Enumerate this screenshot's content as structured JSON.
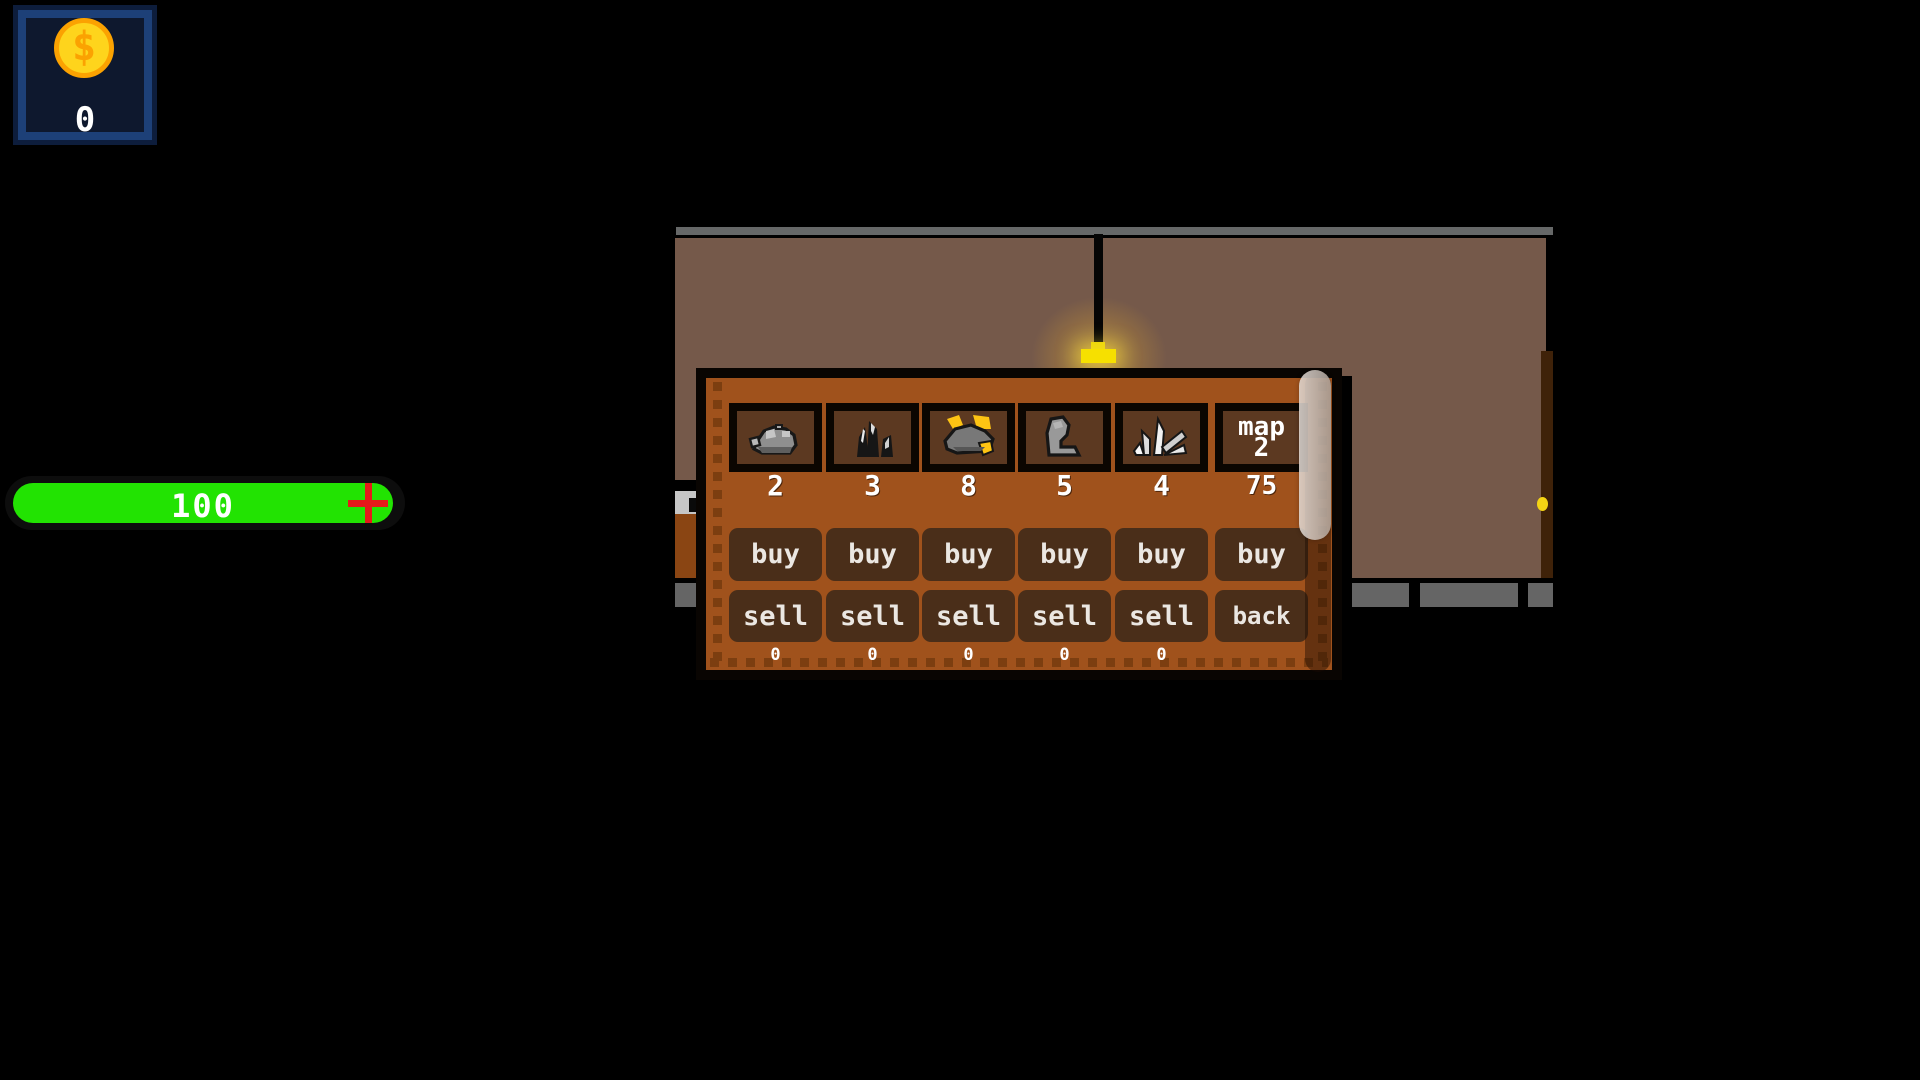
{
  "hud": {
    "money": {
      "symbol": "$",
      "value": "0"
    },
    "health": {
      "value": "100"
    }
  },
  "shop": {
    "items": [
      {
        "name": "stone-ore",
        "price": "2",
        "buy_label": "buy",
        "sell_label": "sell",
        "count": "0"
      },
      {
        "name": "coal",
        "price": "3",
        "buy_label": "buy",
        "sell_label": "sell",
        "count": "0"
      },
      {
        "name": "gold-ore",
        "price": "8",
        "buy_label": "buy",
        "sell_label": "sell",
        "count": "0"
      },
      {
        "name": "leather",
        "price": "5",
        "buy_label": "buy",
        "sell_label": "sell",
        "count": "0"
      },
      {
        "name": "crystal",
        "price": "4",
        "buy_label": "buy",
        "sell_label": "sell",
        "count": "0"
      },
      {
        "name": "map",
        "label_line1": "map",
        "label_line2": "2",
        "price": "75",
        "buy_label": "buy",
        "back_label": "back"
      }
    ]
  },
  "colors": {
    "health_green": "#22e302",
    "cross_red": "#e51a1a",
    "coin_gold": "#fed41c",
    "coin_orange": "#fba201",
    "coin_frame_blue": "#1d4078",
    "panel_orange": "#a0521c",
    "slot_brown": "#5c3921",
    "button_brown": "#4a2e19",
    "wall_brown": "#75594a",
    "structure_gray": "#656565",
    "lamp_yellow": "#f6e000"
  }
}
